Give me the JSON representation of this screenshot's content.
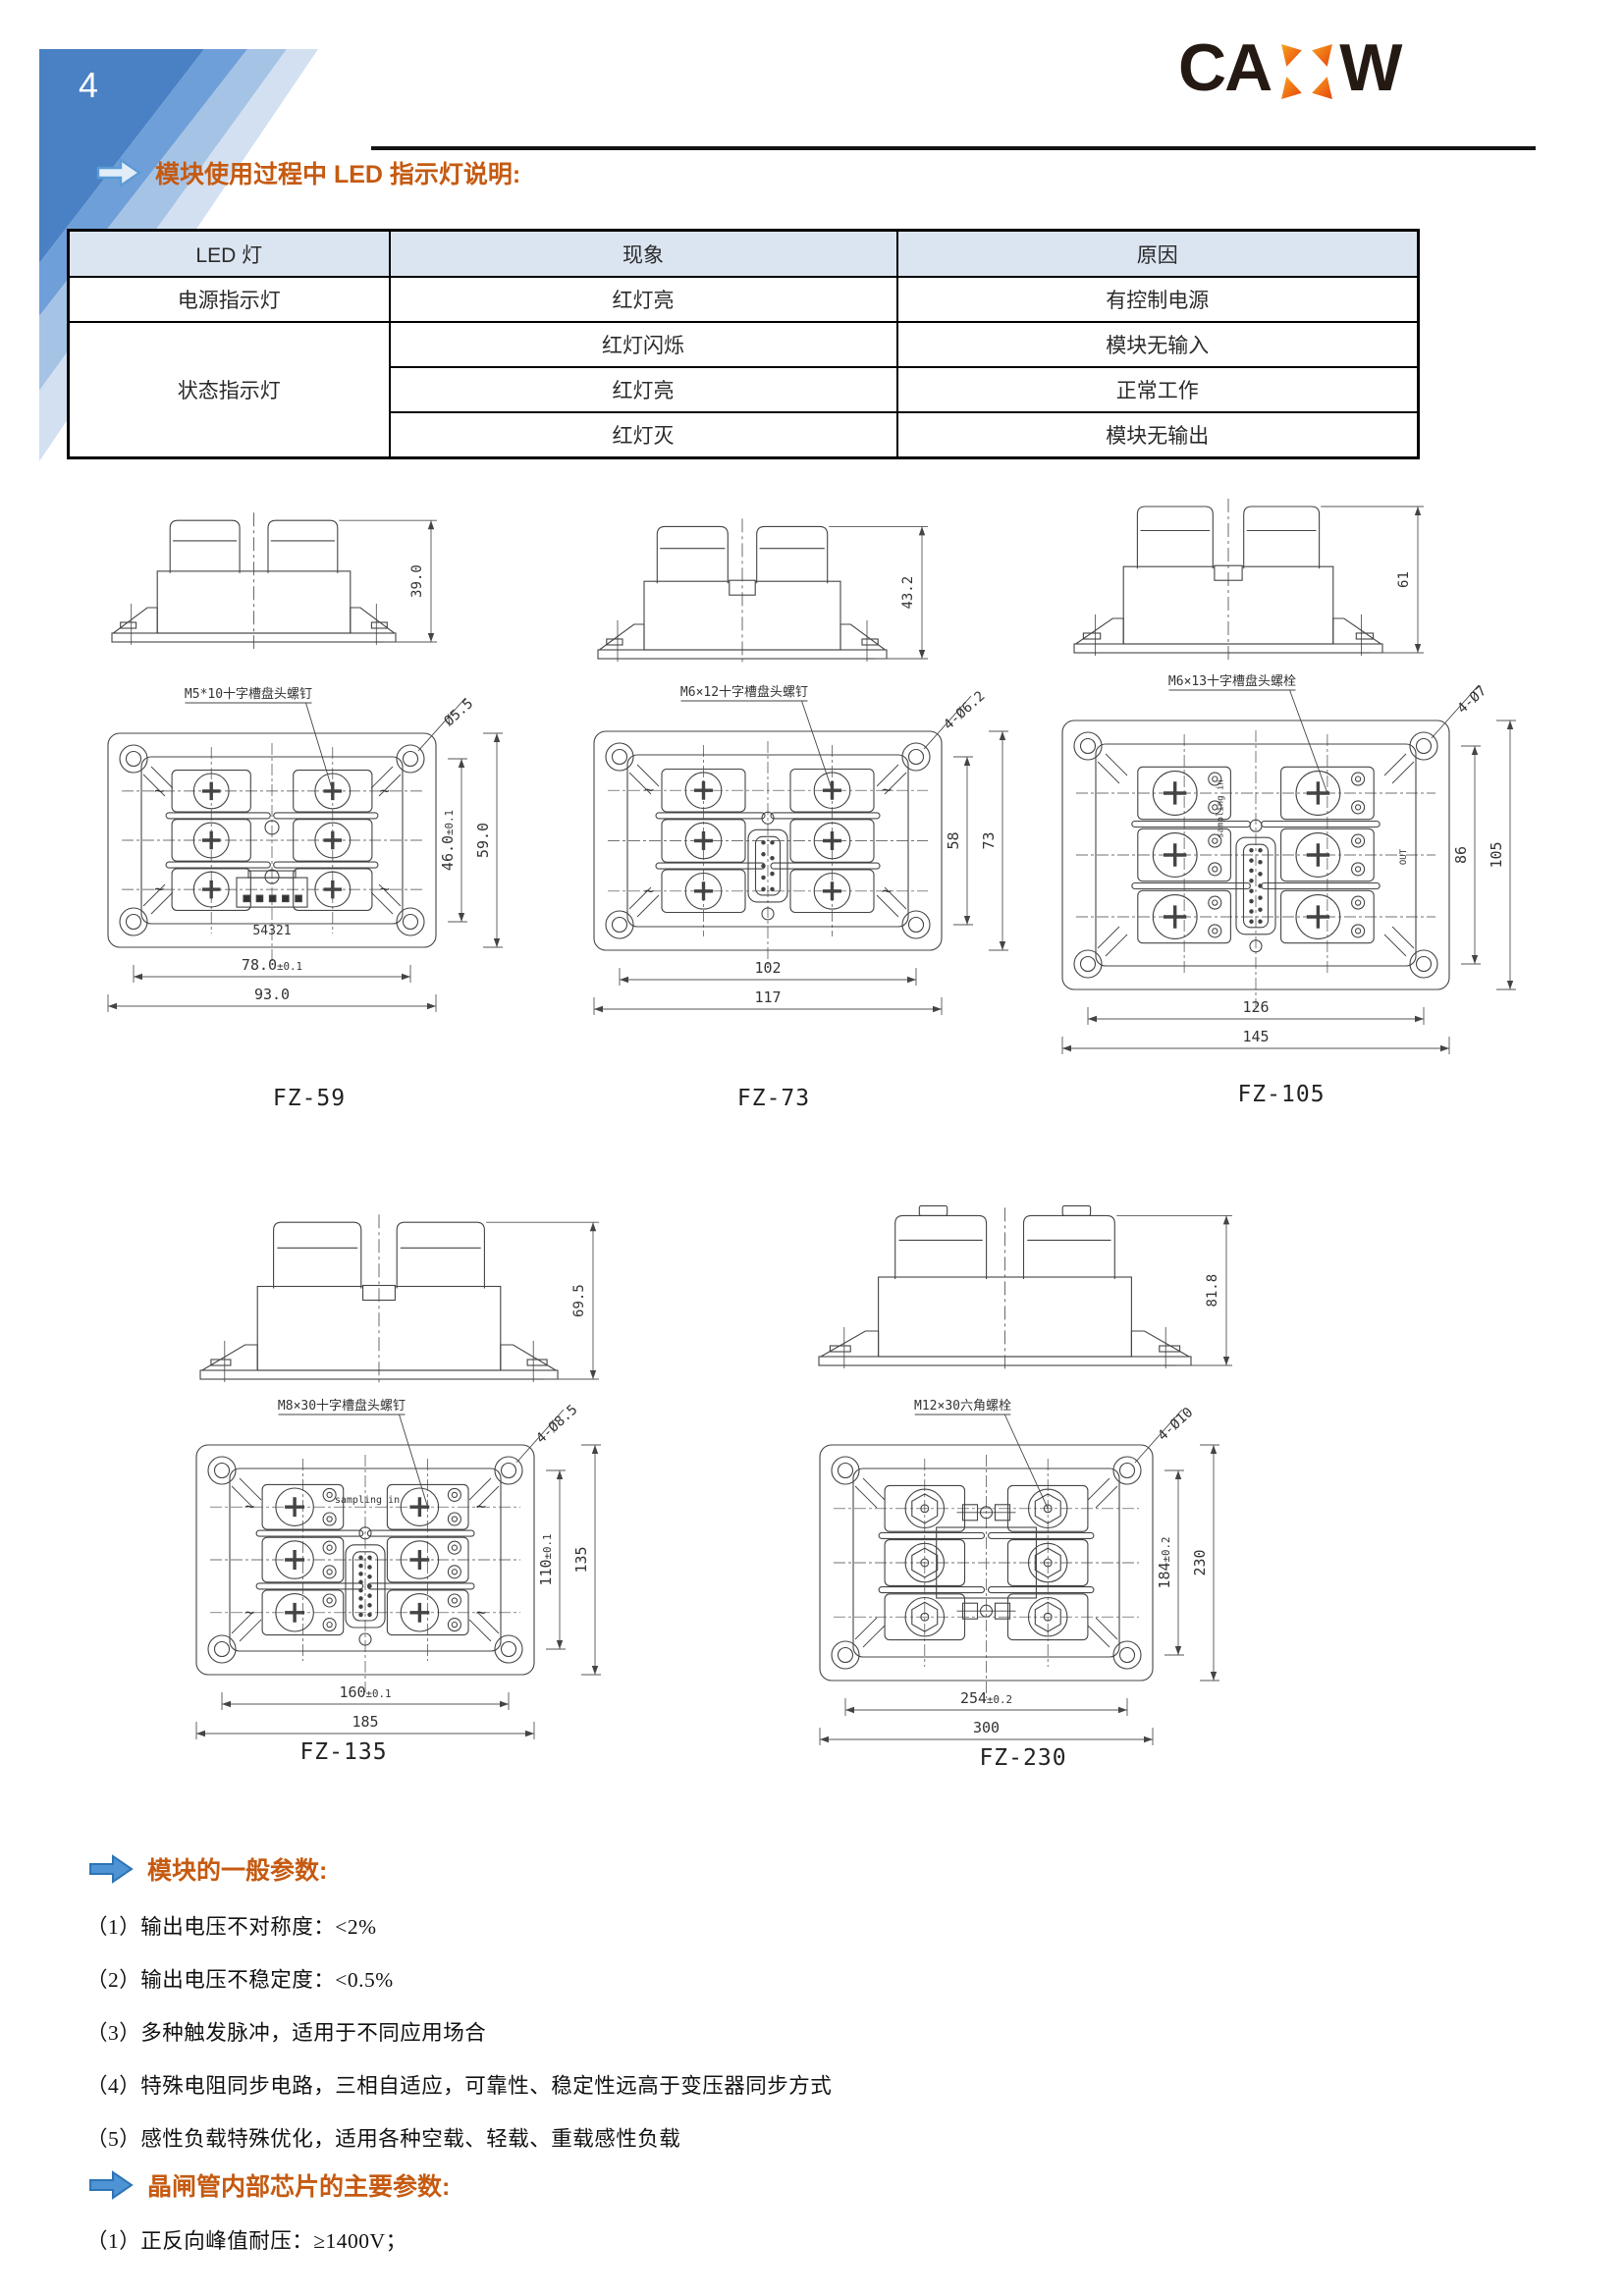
{
  "page": {
    "number": "4"
  },
  "logo": {
    "text_left": "CA",
    "text_right": "W",
    "x_color_top": "#f7a41d",
    "x_color_bottom": "#e8420e"
  },
  "heading_led": "模块使用过程中 LED 指示灯说明:",
  "table": {
    "headers": [
      "LED 灯",
      "现象",
      "原因"
    ],
    "rows": [
      {
        "led": "电源指示灯",
        "phenomenon": "红灯亮",
        "reason": "有控制电源"
      },
      {
        "led": "状态指示灯",
        "phenomenon": "红灯闪烁",
        "reason": "模块无输入"
      },
      {
        "phenomenon": "红灯亮",
        "reason": "正常工作"
      },
      {
        "phenomenon": "红灯灭",
        "reason": "模块无输出"
      }
    ]
  },
  "modules": [
    {
      "id": "fz59",
      "caption": "FZ-59",
      "side_height": "39.0",
      "screw_label": "M5*10十字槽盘头螺钉",
      "hole_label": "Ø5.5",
      "dim_v_inner": "46.0±0.1",
      "dim_v_outer": "59.0",
      "dim_h_inner": "78.0±0.1",
      "dim_h_outer": "93.0",
      "connector_label": "54321"
    },
    {
      "id": "fz73",
      "caption": "FZ-73",
      "side_height": "43.2",
      "screw_label": "M6×12十字槽盘头螺钉",
      "hole_label": "4-Ø6.2",
      "dim_v_inner": "58",
      "dim_v_outer": "73",
      "dim_h_inner": "102",
      "dim_h_outer": "117"
    },
    {
      "id": "fz105",
      "caption": "FZ-105",
      "side_height": "61",
      "screw_label": "M6×13十字槽盘头螺栓",
      "hole_label": "4-Ø7",
      "dim_v_inner": "86",
      "dim_v_outer": "105",
      "dim_h_inner": "126",
      "dim_h_outer": "145",
      "extra_top": "sampling in",
      "extra_right": "OUT"
    },
    {
      "id": "fz135",
      "caption": "FZ-135",
      "side_height": "69.5",
      "screw_label": "M8×30十字槽盘头螺钉",
      "hole_label": "4-Ø8.5",
      "dim_v_inner": "110±0.1",
      "dim_v_outer": "135",
      "dim_h_inner": "160±0.1",
      "dim_h_outer": "185",
      "extra_top": "sampling in"
    },
    {
      "id": "fz230",
      "caption": "FZ-230",
      "side_height": "81.8",
      "screw_label": "M12×30六角螺栓",
      "hole_label": "4-Ø10",
      "dim_v_inner": "184±0.2",
      "dim_v_outer": "230",
      "dim_h_inner": "254±0.2",
      "dim_h_outer": "300"
    }
  ],
  "params_heading": "模块的一般参数:",
  "params": [
    "（1）输出电压不对称度：<2%",
    "（2）输出电压不稳定度：<0.5%",
    "（3）多种触发脉冲，适用于不同应用场合",
    "（4）特殊电阻同步电路，三相自适应，可靠性、稳定性远高于变压器同步方式",
    "（5）感性负载特殊优化，适用各种空载、轻载、重载感性负载"
  ],
  "chip_heading": "晶闸管内部芯片的主要参数:",
  "chip_params": [
    "（1）正反向峰值耐压：≥1400V；"
  ]
}
